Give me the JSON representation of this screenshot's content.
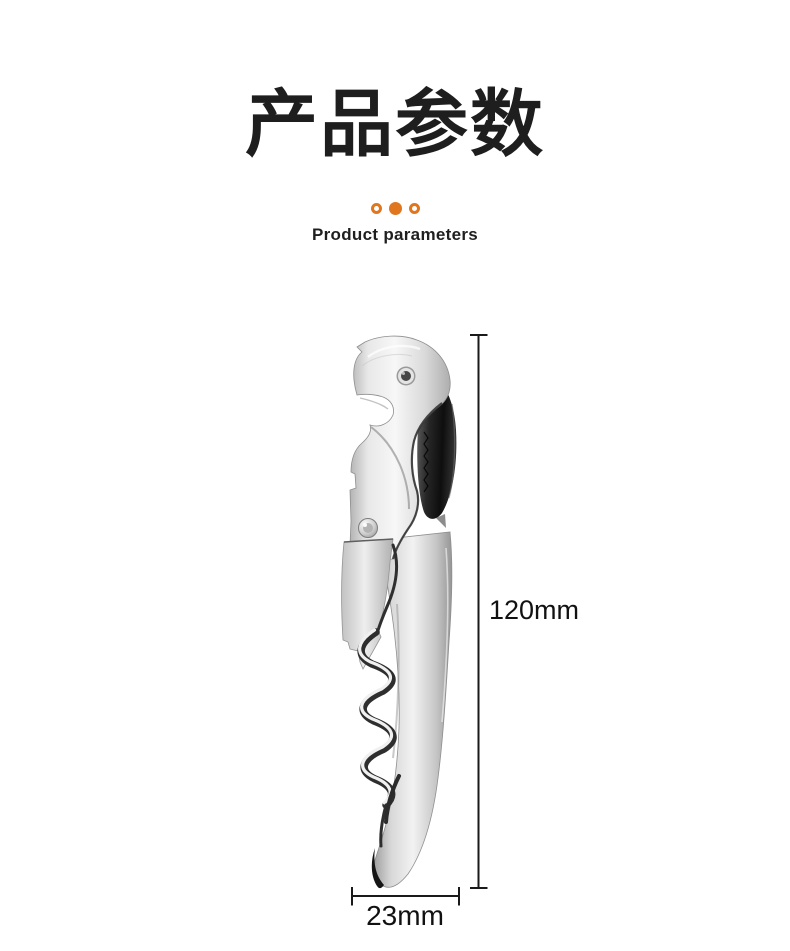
{
  "page": {
    "background": "#ffffff"
  },
  "header": {
    "title": "产品参数",
    "subtitle": "Product parameters",
    "accent_color": "#E0761E",
    "dots": [
      "ring",
      "solid",
      "ring"
    ]
  },
  "figure": {
    "image_name": "stainless-steel-waiter-corkscrew",
    "dimensions": {
      "height_label": "120mm",
      "width_label": "23mm"
    },
    "line_color": "#1a1a1a",
    "metal_colors": {
      "light": "#f6f6f6",
      "mid": "#d8d8d8",
      "dark": "#9a9a9a",
      "blade": "#161616"
    }
  }
}
